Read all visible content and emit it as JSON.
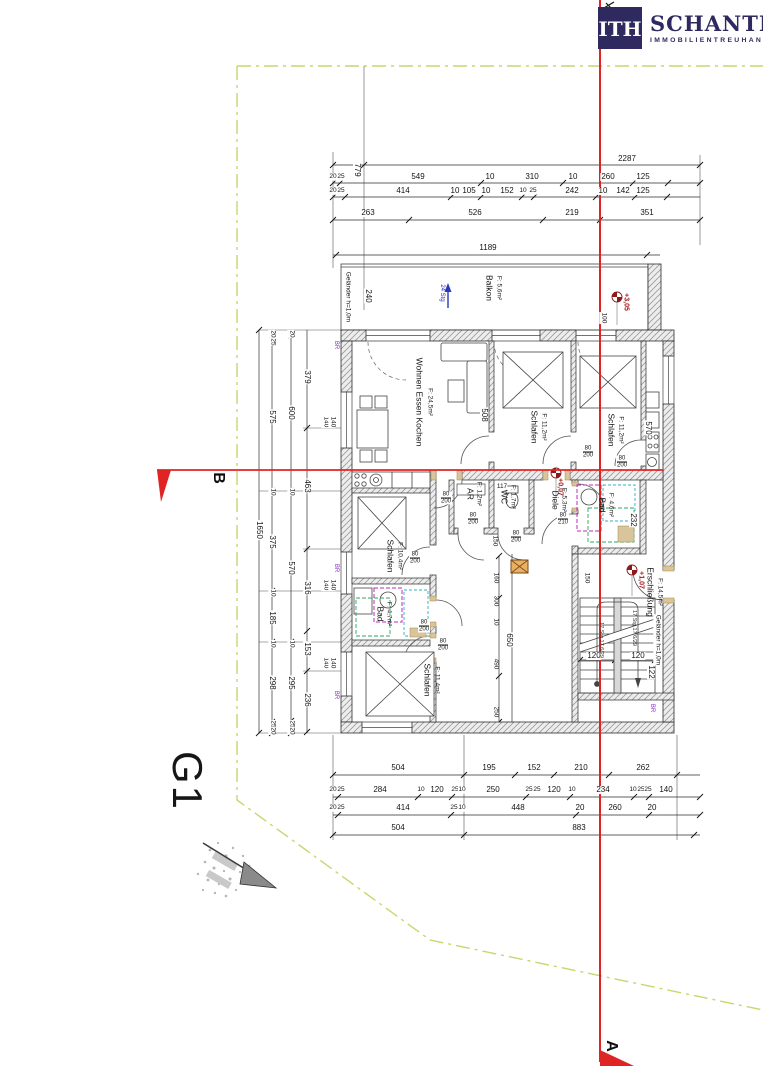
{
  "meta": {
    "drawing": "floor-plan",
    "sheet": "Grundriss"
  },
  "logo": {
    "mark": "ITH",
    "name": "SCHANTL",
    "subtitle": "IMMOBILIENTREUHAND"
  },
  "colors": {
    "accent_red": "#e02424",
    "logo_navy": "#2e2a60",
    "property_line": "#c6d76e",
    "bath_magenta": "#c02ac0",
    "bath_green": "#28a860",
    "bath_cyan": "#30b0c0",
    "wood_tan": "#d9c59b",
    "annotation_blue": "#2830b8",
    "annotation_purple": "#8828c8",
    "level_red": "#a81616"
  },
  "site": {
    "label": "G1"
  },
  "sections": {
    "a": "A",
    "b": "B"
  },
  "annotations": [
    {
      "name": "top-dim-label",
      "cls": "dim",
      "items": [
        {
          "t": "2287",
          "x": 627,
          "y": 159
        },
        {
          "t": "779",
          "x": 357,
          "y": 170,
          "r": 90
        },
        {
          "t": "20",
          "x": 333,
          "y": 177,
          "c": "tiny"
        },
        {
          "t": "25",
          "x": 341,
          "y": 177,
          "c": "tiny"
        },
        {
          "t": "549",
          "x": 418,
          "y": 177
        },
        {
          "t": "10",
          "x": 490,
          "y": 177
        },
        {
          "t": "310",
          "x": 532,
          "y": 177
        },
        {
          "t": "10",
          "x": 573,
          "y": 177
        },
        {
          "t": "260",
          "x": 608,
          "y": 177
        },
        {
          "t": "125",
          "x": 643,
          "y": 177
        },
        {
          "t": "20",
          "x": 333,
          "y": 191,
          "c": "tiny"
        },
        {
          "t": "25",
          "x": 341,
          "y": 191,
          "c": "tiny"
        },
        {
          "t": "414",
          "x": 403,
          "y": 191
        },
        {
          "t": "10",
          "x": 455,
          "y": 191
        },
        {
          "t": "105",
          "x": 469,
          "y": 191
        },
        {
          "t": "10",
          "x": 486,
          "y": 191
        },
        {
          "t": "152",
          "x": 507,
          "y": 191
        },
        {
          "t": "10",
          "x": 523,
          "y": 191,
          "c": "tiny"
        },
        {
          "t": "25",
          "x": 533,
          "y": 191,
          "c": "tiny"
        },
        {
          "t": "242",
          "x": 572,
          "y": 191
        },
        {
          "t": "10",
          "x": 603,
          "y": 191
        },
        {
          "t": "142",
          "x": 623,
          "y": 191
        },
        {
          "t": "125",
          "x": 643,
          "y": 191
        },
        {
          "t": "263",
          "x": 368,
          "y": 213
        },
        {
          "t": "526",
          "x": 475,
          "y": 213
        },
        {
          "t": "219",
          "x": 572,
          "y": 213
        },
        {
          "t": "351",
          "x": 647,
          "y": 213
        },
        {
          "t": "1189",
          "x": 488,
          "y": 248
        }
      ]
    },
    {
      "name": "bottom-dim-label",
      "cls": "dim",
      "items": [
        {
          "t": "504",
          "x": 398,
          "y": 768
        },
        {
          "t": "195",
          "x": 489,
          "y": 768
        },
        {
          "t": "152",
          "x": 534,
          "y": 768
        },
        {
          "t": "210",
          "x": 581,
          "y": 768
        },
        {
          "t": "262",
          "x": 643,
          "y": 768
        },
        {
          "t": "20",
          "x": 333,
          "y": 790,
          "c": "tiny"
        },
        {
          "t": "25",
          "x": 341,
          "y": 790,
          "c": "tiny"
        },
        {
          "t": "284",
          "x": 380,
          "y": 790
        },
        {
          "t": "10",
          "x": 421,
          "y": 790,
          "c": "tiny"
        },
        {
          "t": "120",
          "x": 437,
          "y": 790
        },
        {
          "t": "25",
          "x": 455,
          "y": 790,
          "c": "tiny"
        },
        {
          "t": "10",
          "x": 462,
          "y": 790,
          "c": "tiny"
        },
        {
          "t": "250",
          "x": 493,
          "y": 790
        },
        {
          "t": "25",
          "x": 529,
          "y": 790,
          "c": "tiny"
        },
        {
          "t": "25",
          "x": 537,
          "y": 790,
          "c": "tiny"
        },
        {
          "t": "120",
          "x": 554,
          "y": 790
        },
        {
          "t": "10",
          "x": 572,
          "y": 790,
          "c": "tiny"
        },
        {
          "t": "234",
          "x": 603,
          "y": 790
        },
        {
          "t": "10",
          "x": 633,
          "y": 790,
          "c": "tiny"
        },
        {
          "t": "25",
          "x": 641,
          "y": 790,
          "c": "tiny"
        },
        {
          "t": "25",
          "x": 648,
          "y": 790,
          "c": "tiny"
        },
        {
          "t": "140",
          "x": 666,
          "y": 790
        },
        {
          "t": "20",
          "x": 333,
          "y": 808,
          "c": "tiny"
        },
        {
          "t": "25",
          "x": 341,
          "y": 808,
          "c": "tiny"
        },
        {
          "t": "414",
          "x": 403,
          "y": 808
        },
        {
          "t": "25",
          "x": 454,
          "y": 808,
          "c": "tiny"
        },
        {
          "t": "10",
          "x": 462,
          "y": 808,
          "c": "tiny"
        },
        {
          "t": "448",
          "x": 518,
          "y": 808
        },
        {
          "t": "20",
          "x": 580,
          "y": 808
        },
        {
          "t": "260",
          "x": 615,
          "y": 808
        },
        {
          "t": "20",
          "x": 652,
          "y": 808
        },
        {
          "t": "504",
          "x": 398,
          "y": 828
        },
        {
          "t": "883",
          "x": 579,
          "y": 828
        }
      ]
    },
    {
      "name": "left-dim-label",
      "cls": "dim",
      "items": [
        {
          "t": "1650",
          "x": 259,
          "y": 530,
          "r": 90
        },
        {
          "t": "20",
          "x": 272,
          "y": 334,
          "r": 90,
          "c": "tiny"
        },
        {
          "t": "25",
          "x": 272,
          "y": 342,
          "r": 90,
          "c": "tiny"
        },
        {
          "t": "575",
          "x": 272,
          "y": 417,
          "r": 90
        },
        {
          "t": "10",
          "x": 272,
          "y": 492,
          "r": 90,
          "c": "tiny"
        },
        {
          "t": "375",
          "x": 272,
          "y": 542,
          "r": 90
        },
        {
          "t": "10",
          "x": 272,
          "y": 593,
          "r": 90,
          "c": "tiny"
        },
        {
          "t": "185",
          "x": 272,
          "y": 618,
          "r": 90
        },
        {
          "t": "10",
          "x": 272,
          "y": 644,
          "r": 90,
          "c": "tiny"
        },
        {
          "t": "298",
          "x": 272,
          "y": 683,
          "r": 90
        },
        {
          "t": "25",
          "x": 272,
          "y": 724,
          "r": 90,
          "c": "tiny"
        },
        {
          "t": "20",
          "x": 272,
          "y": 731,
          "r": 90,
          "c": "tiny"
        },
        {
          "t": "20",
          "x": 291,
          "y": 334,
          "r": 90,
          "c": "tiny"
        },
        {
          "t": "600",
          "x": 291,
          "y": 413,
          "r": 90
        },
        {
          "t": "10",
          "x": 291,
          "y": 492,
          "r": 90,
          "c": "tiny"
        },
        {
          "t": "570",
          "x": 291,
          "y": 568,
          "r": 90
        },
        {
          "t": "10",
          "x": 291,
          "y": 644,
          "r": 90,
          "c": "tiny"
        },
        {
          "t": "295",
          "x": 291,
          "y": 683,
          "r": 90
        },
        {
          "t": "25",
          "x": 291,
          "y": 724,
          "r": 90,
          "c": "tiny"
        },
        {
          "t": "20",
          "x": 291,
          "y": 731,
          "r": 90,
          "c": "tiny"
        },
        {
          "t": "379",
          "x": 307,
          "y": 377,
          "r": 90
        },
        {
          "t": "463",
          "x": 307,
          "y": 486,
          "r": 90
        },
        {
          "t": "316",
          "x": 307,
          "y": 588,
          "r": 90
        },
        {
          "t": "153",
          "x": 307,
          "y": 649,
          "r": 90
        },
        {
          "t": "236",
          "x": 307,
          "y": 700,
          "r": 90
        },
        {
          "t": "140",
          "x": 325,
          "y": 422,
          "r": 90,
          "c": "tiny"
        },
        {
          "t": "140",
          "x": 332,
          "y": 422,
          "r": 90,
          "c": "tiny"
        },
        {
          "t": "140",
          "x": 325,
          "y": 585,
          "r": 90,
          "c": "tiny"
        },
        {
          "t": "140",
          "x": 332,
          "y": 585,
          "r": 90,
          "c": "tiny"
        },
        {
          "t": "140",
          "x": 325,
          "y": 663,
          "r": 90,
          "c": "tiny"
        },
        {
          "t": "140",
          "x": 332,
          "y": 663,
          "r": 90,
          "c": "tiny"
        }
      ]
    },
    {
      "name": "plan-dim-label",
      "cls": "dim",
      "items": [
        {
          "t": "240",
          "x": 368,
          "y": 296,
          "r": 90
        },
        {
          "t": "100",
          "x": 603,
          "y": 318,
          "r": 90,
          "c": "tiny"
        },
        {
          "t": "508",
          "x": 484,
          "y": 415,
          "r": 90
        },
        {
          "t": "570",
          "x": 648,
          "y": 428,
          "r": 90
        },
        {
          "t": "117",
          "x": 502,
          "y": 487,
          "c": "tiny"
        },
        {
          "t": "150",
          "x": 494,
          "y": 541,
          "r": 90,
          "c": "tiny"
        },
        {
          "t": "232",
          "x": 633,
          "y": 520,
          "r": 90
        },
        {
          "t": "160",
          "x": 495,
          "y": 578,
          "r": 90,
          "c": "tiny"
        },
        {
          "t": "300",
          "x": 495,
          "y": 601,
          "r": 90,
          "c": "tiny"
        },
        {
          "t": "10",
          "x": 495,
          "y": 622,
          "r": 90,
          "c": "tiny"
        },
        {
          "t": "490",
          "x": 495,
          "y": 664,
          "r": 90,
          "c": "tiny"
        },
        {
          "t": "250",
          "x": 495,
          "y": 712,
          "r": 90,
          "c": "tiny"
        },
        {
          "t": "650",
          "x": 509,
          "y": 640,
          "r": 90
        },
        {
          "t": "150",
          "x": 586,
          "y": 578,
          "r": 90,
          "c": "tiny"
        },
        {
          "t": "120",
          "x": 594,
          "y": 656
        },
        {
          "t": "120",
          "x": 638,
          "y": 656
        },
        {
          "t": "122",
          "x": 651,
          "y": 672,
          "r": 90
        }
      ]
    },
    {
      "name": "room-label",
      "cls": "room",
      "items": [
        {
          "t": "Balkon",
          "x": 489,
          "y": 288,
          "r": 90
        },
        {
          "t": "F: 5,6m²",
          "x": 498,
          "y": 288,
          "r": 90,
          "c": "roomsub"
        },
        {
          "t": "Wohnen Essen Kochen",
          "x": 419,
          "y": 402,
          "r": 90
        },
        {
          "t": "F: 24,5m²",
          "x": 429,
          "y": 402,
          "r": 90,
          "c": "roomsub"
        },
        {
          "t": "Schlafen",
          "x": 534,
          "y": 427,
          "r": 90
        },
        {
          "t": "F: 11,2m²",
          "x": 543,
          "y": 427,
          "r": 90,
          "c": "roomsub"
        },
        {
          "t": "Schlafen",
          "x": 611,
          "y": 430,
          "r": 90
        },
        {
          "t": "F: 11,2m²",
          "x": 620,
          "y": 430,
          "r": 90,
          "c": "roomsub"
        },
        {
          "t": "Schlafen",
          "x": 390,
          "y": 556,
          "r": 90
        },
        {
          "t": "F: 10,4m²",
          "x": 399,
          "y": 556,
          "r": 90,
          "c": "roomsub"
        },
        {
          "t": "AR",
          "x": 470,
          "y": 494,
          "r": 90
        },
        {
          "t": "F: 1,2m²",
          "x": 478,
          "y": 494,
          "r": 90,
          "c": "roomsub"
        },
        {
          "t": "WC",
          "x": 504,
          "y": 497,
          "r": 90
        },
        {
          "t": "F: 1,7m²",
          "x": 512,
          "y": 497,
          "r": 90,
          "c": "roomsub"
        },
        {
          "t": "Diele",
          "x": 555,
          "y": 500,
          "r": 90
        },
        {
          "t": "F: 5,3m²",
          "x": 563,
          "y": 500,
          "r": 90,
          "c": "roomsub"
        },
        {
          "t": "Bad",
          "x": 602,
          "y": 505,
          "r": 90
        },
        {
          "t": "F: 4,6m²",
          "x": 610,
          "y": 505,
          "r": 90,
          "c": "roomsub"
        },
        {
          "t": "Bad",
          "x": 380,
          "y": 614,
          "r": 90
        },
        {
          "t": "F: 4,7m²",
          "x": 388,
          "y": 614,
          "r": 90,
          "c": "roomsub"
        },
        {
          "t": "Schlafen",
          "x": 427,
          "y": 680,
          "r": 90
        },
        {
          "t": "F: 11,4m²",
          "x": 436,
          "y": 680,
          "r": 90,
          "c": "roomsub"
        },
        {
          "t": "Erschließung",
          "x": 650,
          "y": 592,
          "r": 90
        },
        {
          "t": "F: 14,5m²",
          "x": 659,
          "y": 592,
          "r": 90,
          "c": "roomsub"
        }
      ]
    },
    {
      "name": "door-size-label",
      "cls": "door",
      "items": [
        {
          "t": "80",
          "t2": "200",
          "x": 446,
          "y": 498
        },
        {
          "t": "80",
          "t2": "200",
          "x": 473,
          "y": 519
        },
        {
          "t": "80",
          "t2": "200",
          "x": 516,
          "y": 537
        },
        {
          "t": "80",
          "t2": "200",
          "x": 622,
          "y": 462
        },
        {
          "t": "80",
          "t2": "210",
          "x": 563,
          "y": 519
        },
        {
          "t": "80",
          "t2": "200",
          "x": 424,
          "y": 626
        },
        {
          "t": "80",
          "t2": "200",
          "x": 443,
          "y": 645
        },
        {
          "t": "80",
          "t2": "200",
          "x": 415,
          "y": 558
        },
        {
          "t": "80",
          "t2": "200",
          "x": 588,
          "y": 452
        }
      ]
    },
    {
      "name": "level-marker-label",
      "cls": "red",
      "items": [
        {
          "t": "+3,05",
          "x": 626,
          "y": 302,
          "r": 90
        },
        {
          "t": "+0,07",
          "x": 560,
          "y": 487,
          "r": 90
        },
        {
          "t": "+1,07",
          "x": 641,
          "y": 580,
          "r": 90
        }
      ]
    },
    {
      "name": "note-label",
      "cls": "tiny",
      "items": [
        {
          "t": "Geländer h=1,0m",
          "x": 347,
          "y": 297,
          "r": 90
        },
        {
          "t": "24 Stg",
          "x": 442,
          "y": 293,
          "r": 90,
          "c": "blue"
        },
        {
          "t": "Geländer h=1,0m",
          "x": 657,
          "y": 640,
          "r": 90
        },
        {
          "t": "17 Stg 17,6/29",
          "x": 600,
          "y": 640,
          "r": 90,
          "c": "micro"
        },
        {
          "t": "17 Stg 17,6/29",
          "x": 633,
          "y": 628,
          "r": 90,
          "c": "micro"
        },
        {
          "t": "BR",
          "x": 336,
          "y": 345,
          "r": 90,
          "c": "purple"
        },
        {
          "t": "BR",
          "x": 336,
          "y": 568,
          "r": 90,
          "c": "purple"
        },
        {
          "t": "BR",
          "x": 336,
          "y": 695,
          "r": 90,
          "c": "purple"
        },
        {
          "t": "BR",
          "x": 652,
          "y": 708,
          "r": 90,
          "c": "purple"
        }
      ]
    },
    {
      "name": "site-label",
      "cls": "big",
      "items": [
        {
          "t": "G1",
          "x": 187,
          "y": 781,
          "r": 90
        }
      ]
    },
    {
      "name": "section-marker-label",
      "cls": "sec",
      "items": [
        {
          "t": "B",
          "x": 218,
          "y": 478,
          "r": 90
        },
        {
          "t": "A",
          "x": 611,
          "y": 1046,
          "r": 90
        }
      ]
    }
  ]
}
